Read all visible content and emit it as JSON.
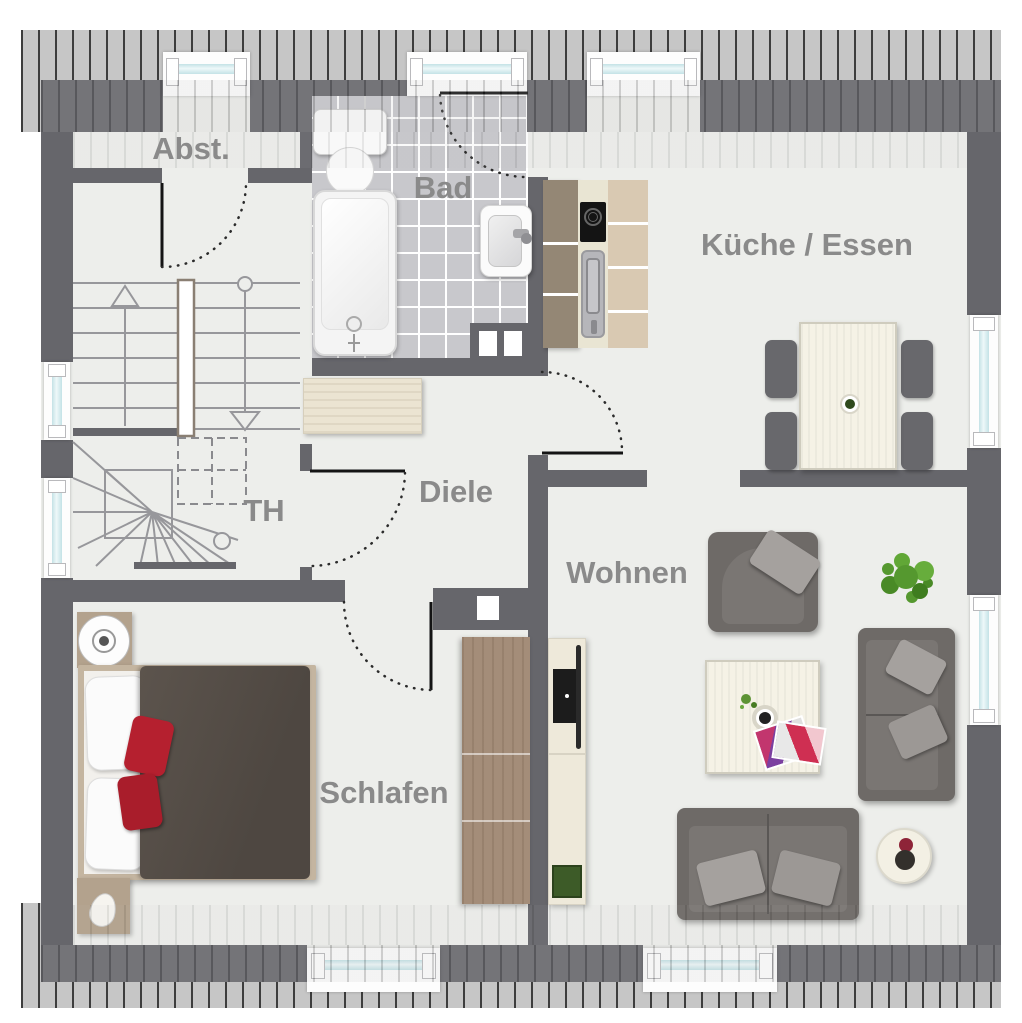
{
  "title": "Obergeschoss Grundriss",
  "rooms": {
    "abst": {
      "label": "Abst."
    },
    "bad": {
      "label": "Bad"
    },
    "kueche": {
      "label": "Küche / Essen"
    },
    "th": {
      "label": "TH"
    },
    "diele": {
      "label": "Diele"
    },
    "wohnen": {
      "label": "Wohnen"
    },
    "schlafen": {
      "label": "Schlafen"
    }
  },
  "colors": {
    "wall": "#66666b",
    "floor": "#edeeeb",
    "tile": "#c8c8cc",
    "glass": "#c3e2e6",
    "hatch_light": "#c6c6c6",
    "hatch_dark": "#3d3d3d",
    "label": "#8a8a8a",
    "wood_light": "#ebe4d2",
    "wood_brown": "#a48d79",
    "sofa_dark": "#6e6a67",
    "cushion_light": "#a5a19e",
    "pillow_red": "#b5202f",
    "plant_green": "#55982f",
    "table_cream": "#f5f2e6"
  }
}
